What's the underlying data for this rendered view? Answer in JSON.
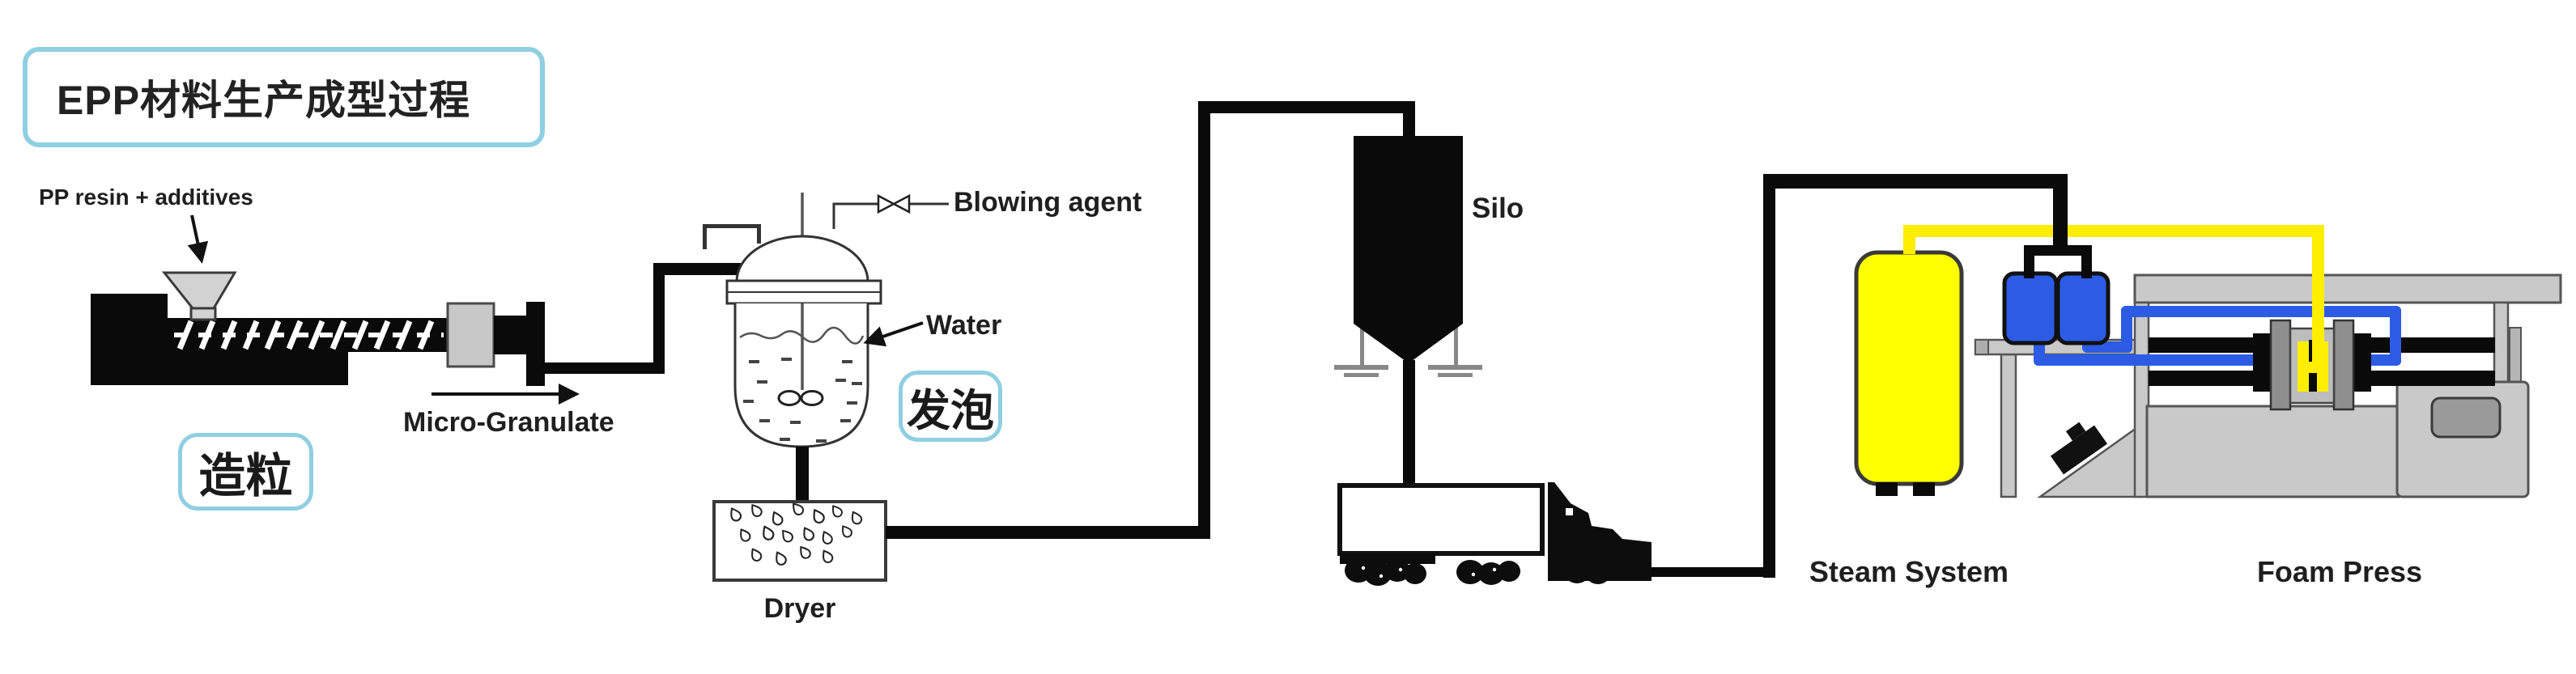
{
  "diagram": {
    "title": "EPP材料生产成型过程",
    "stages": {
      "granulation": "造粒",
      "foaming": "发泡"
    },
    "annotations": {
      "pp_resin": "PP resin + additives",
      "micro_granulate": "Micro-Granulate",
      "blowing_agent": "Blowing agent",
      "water": "Water"
    },
    "equipment": {
      "dryer": "Dryer",
      "silo": "Silo",
      "steam_system": "Steam System",
      "foam_press": "Foam Press"
    },
    "colors": {
      "label_box_border": "#8fcfe2",
      "pipe_yellow": "#ffee00",
      "pipe_blue": "#2c5ce5",
      "pipe_black": "#0a0a0a",
      "machine_gray": "#c9c9c9",
      "steam_tank_yellow": "#ffff00",
      "blue_tank": "#2c5ce5"
    }
  }
}
